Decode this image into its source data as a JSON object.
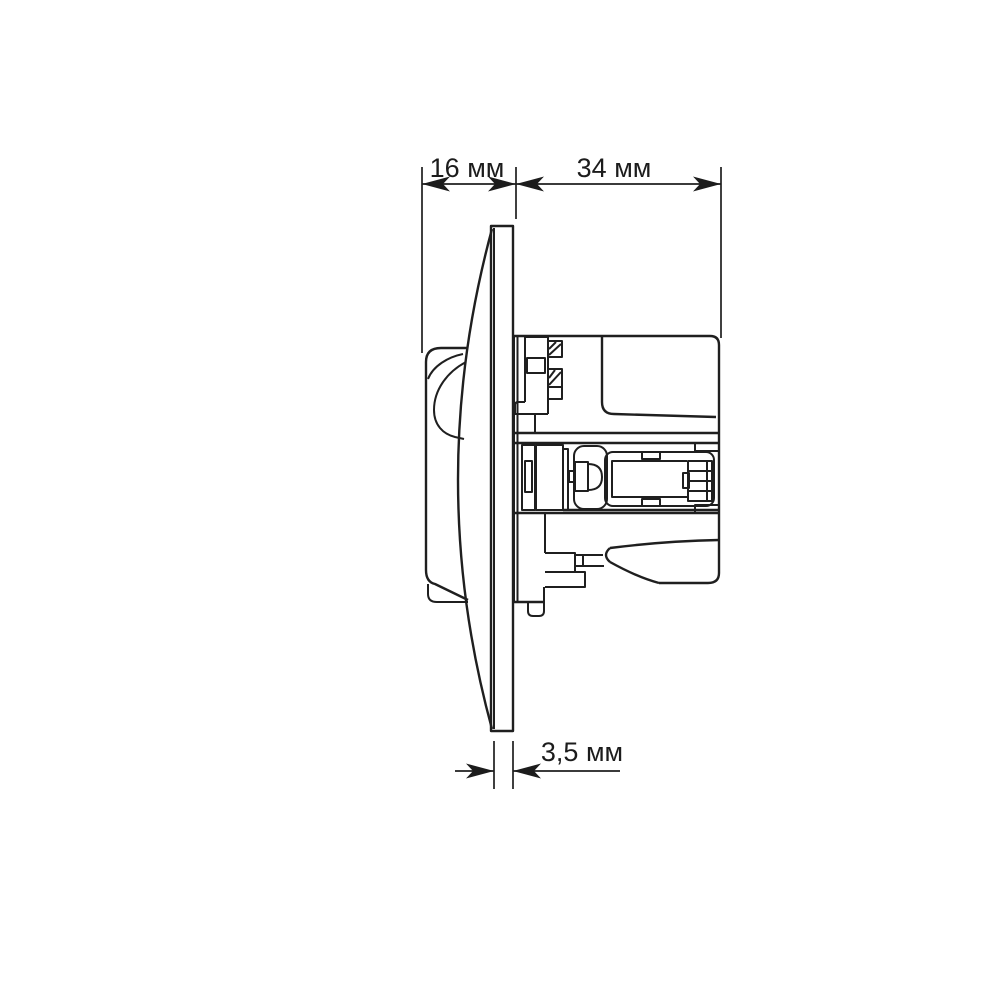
{
  "drawing": {
    "title": "socket-side-view-dimension-drawing",
    "background_color": "#ffffff",
    "line_color": "#1f1f1f"
  },
  "dimensions": {
    "front_depth": {
      "label": "16 мм",
      "value": 16,
      "unit": "мм"
    },
    "mounting_depth": {
      "label": "34 мм",
      "value": 34,
      "unit": "мм"
    },
    "plate_thickness": {
      "label": "3,5 мм",
      "value": 3.5,
      "unit": "мм"
    }
  }
}
